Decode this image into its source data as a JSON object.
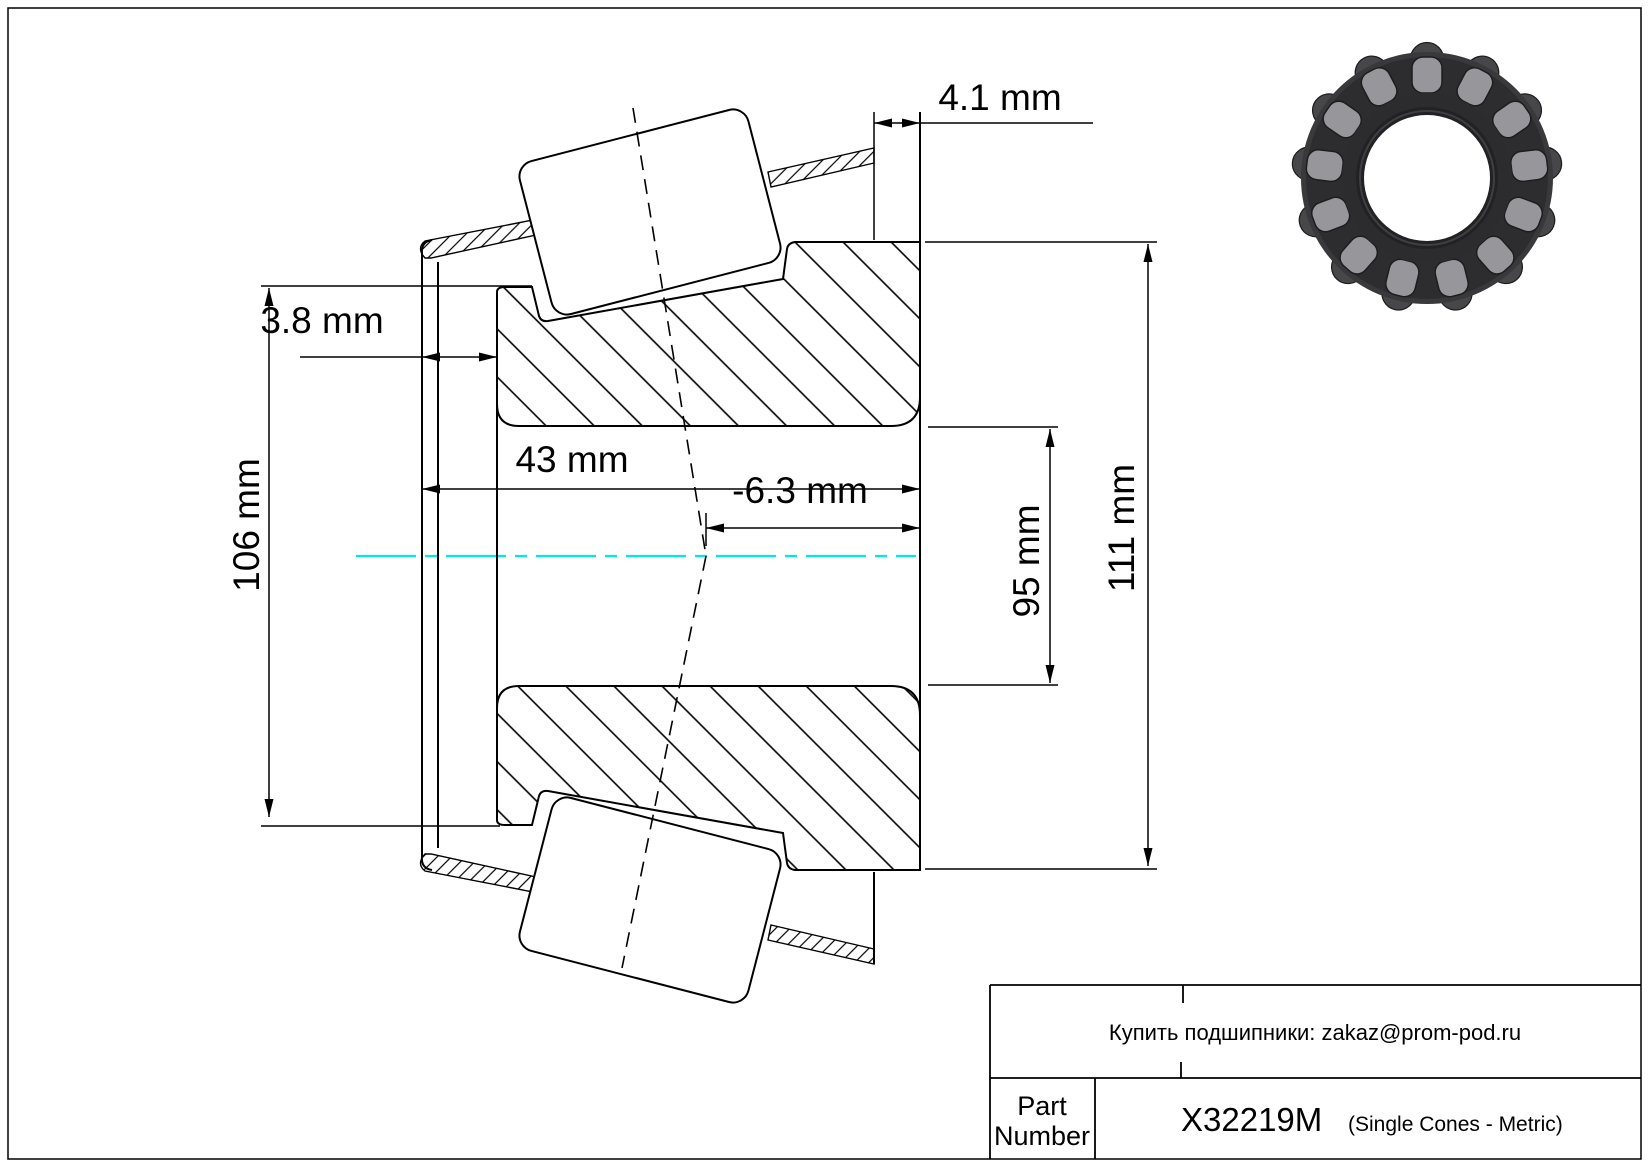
{
  "drawing": {
    "type": "technical-drawing",
    "subject": "tapered roller bearing single cone cross-section",
    "dims": {
      "top_offset": "4.1 mm",
      "front_offset": "3.8 mm",
      "cage_od": "106 mm",
      "width": "43 mm",
      "apex": "-6.3 mm",
      "bore": "95 mm",
      "od": "111 mm"
    },
    "colors": {
      "line": "#000000",
      "centerline": "#00e8e8",
      "background": "#ffffff"
    }
  },
  "title_block": {
    "note": "Купить подшипники: zakaz@prom-pod.ru",
    "part_label_line1": "Part",
    "part_label_line2": "Number",
    "part_number": "X32219M",
    "part_type": "(Single Cones - Metric)"
  }
}
